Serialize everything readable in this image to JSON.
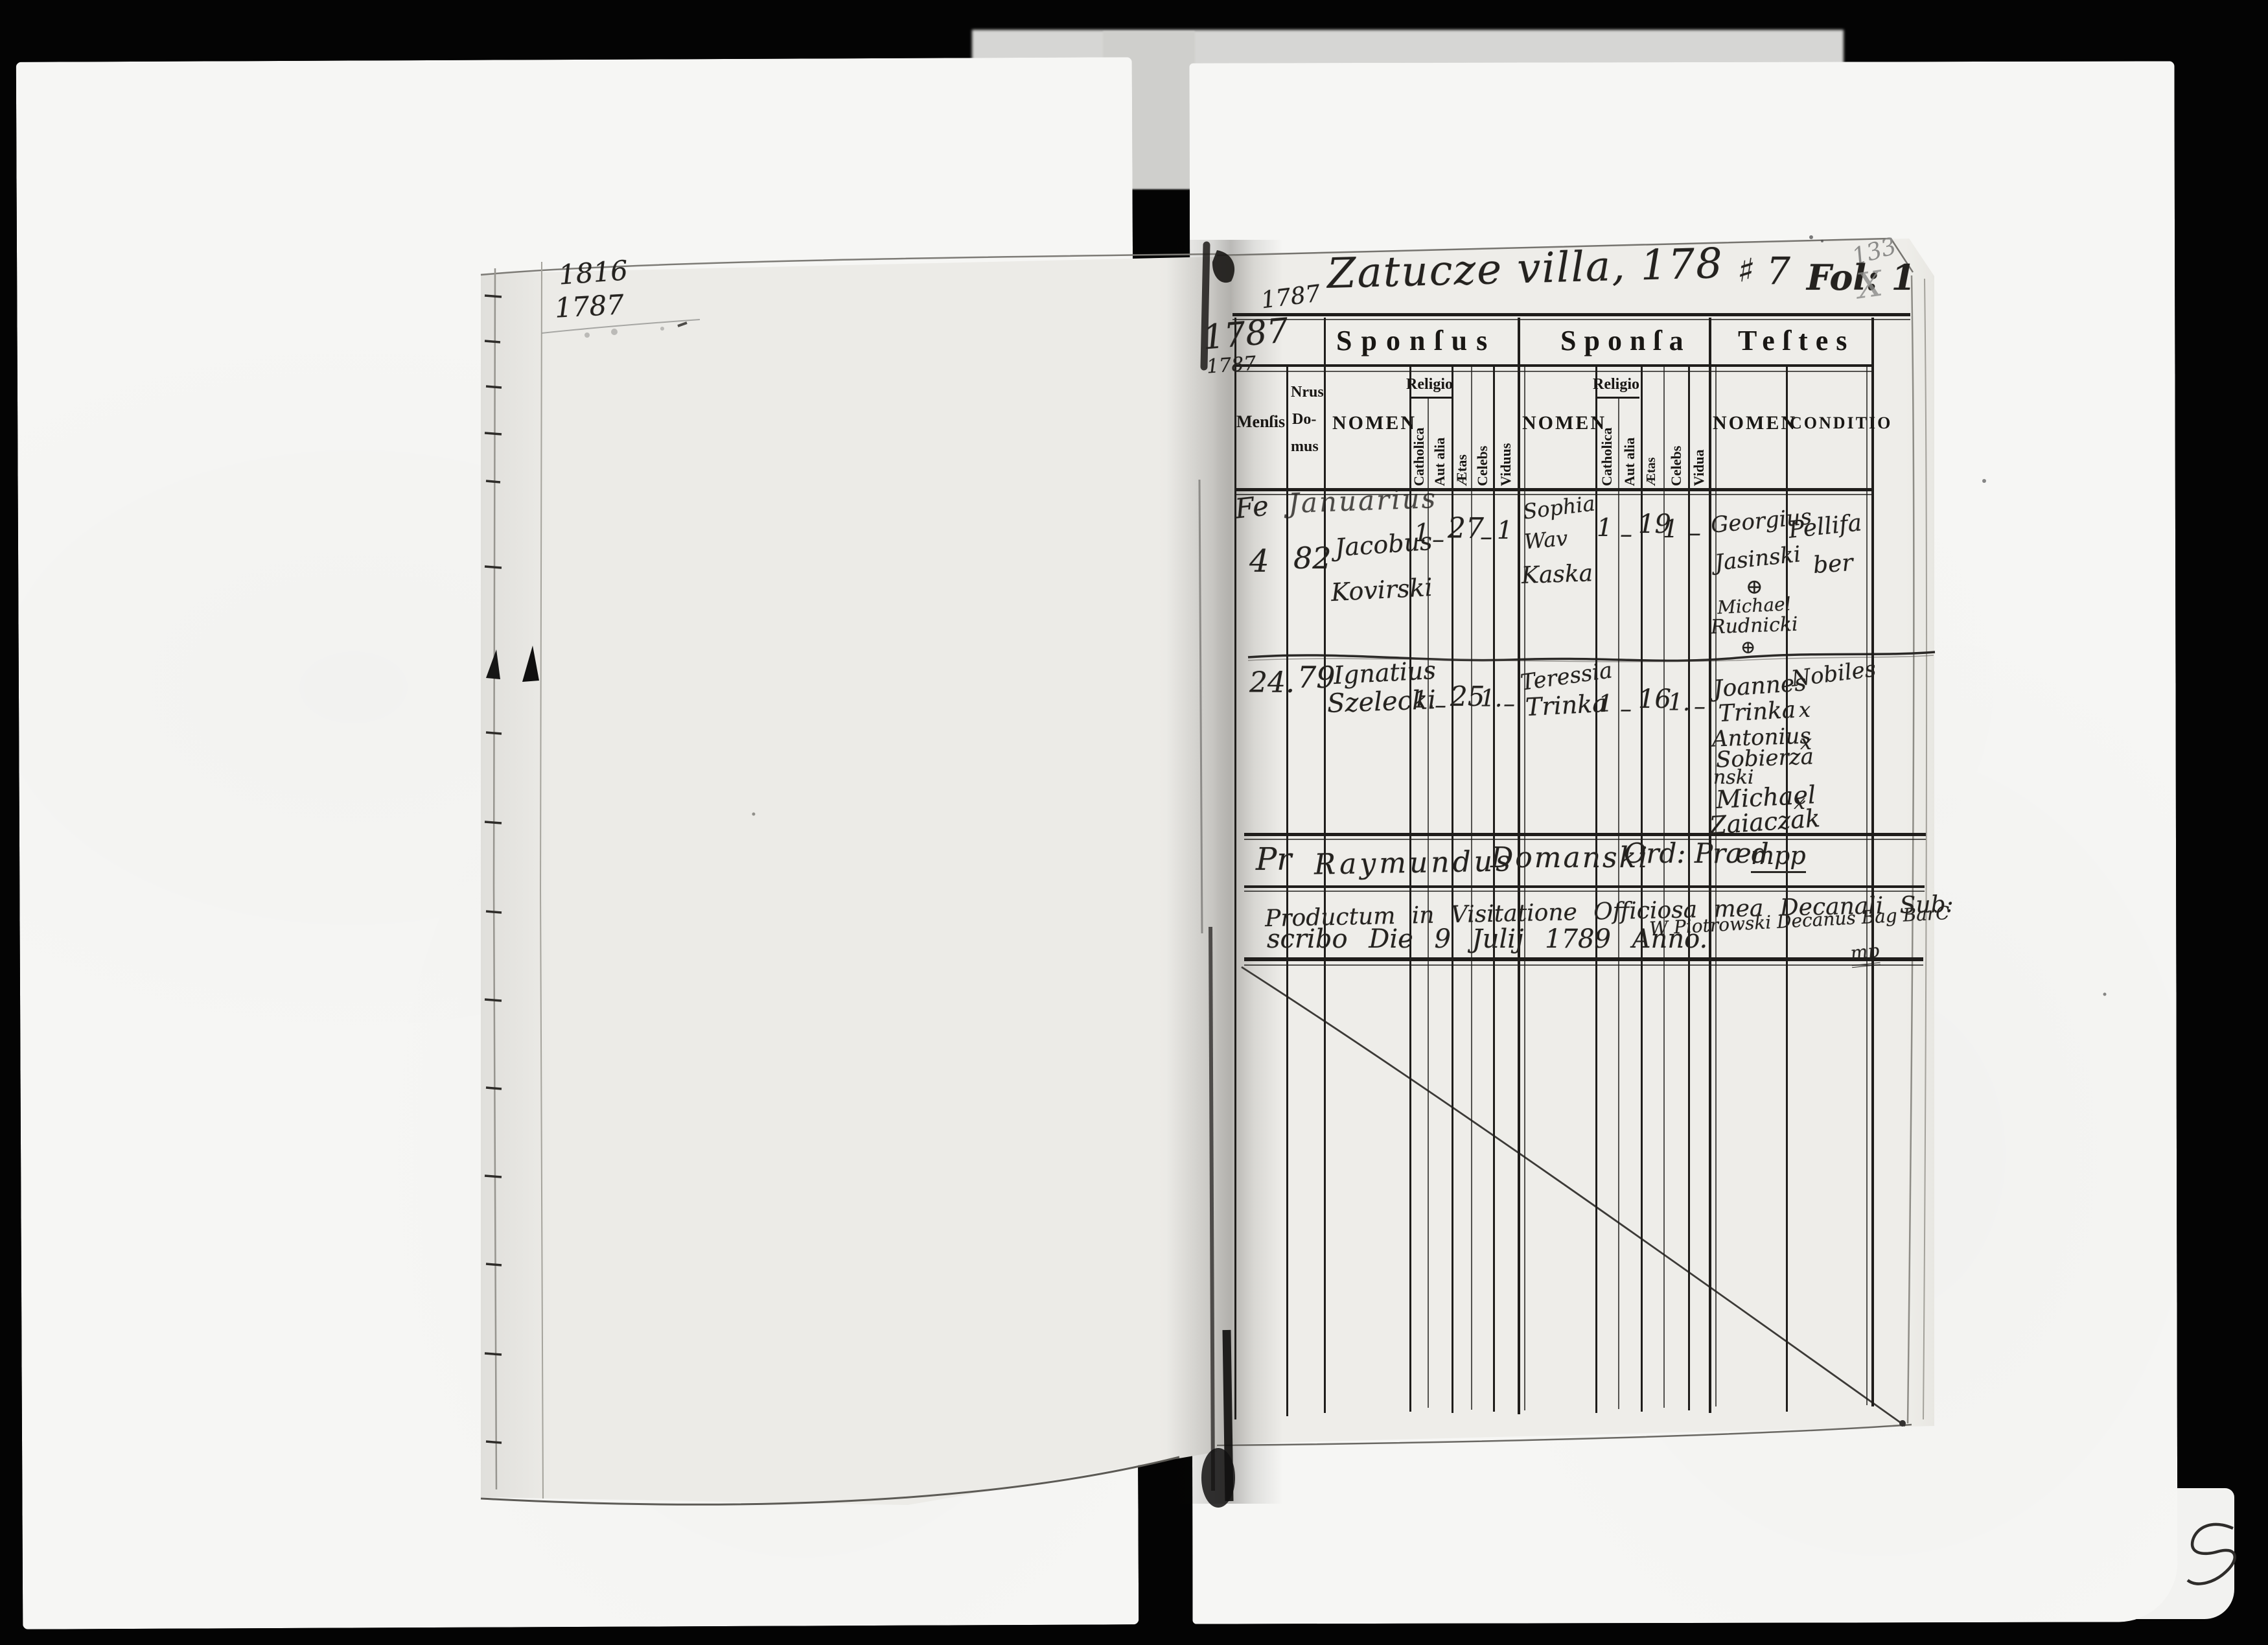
{
  "left_page": {
    "note_year_top": "1816",
    "note_year_bottom": "1787"
  },
  "right_page": {
    "pencil_folio": "133",
    "pencil_x": "X",
    "title": "Zatucze villa, 178",
    "title_mark": "♯",
    "title_suffix": "7",
    "folio": "Fol: 1",
    "margin_year": "1787",
    "cell_year_big": "1787",
    "cell_year_small": "1787"
  },
  "table": {
    "group_headers": {
      "sponsus": "Sponſus",
      "sponsa": "Sponſa",
      "testes": "Teſtes"
    },
    "columns": {
      "mensis": "Menſis",
      "nrus_line1": "Nrus",
      "nrus_line2": "Do-",
      "nrus_line3": "mus",
      "nomen": "NOMEN",
      "religio": "Religio",
      "catholica": "Catholica",
      "aut_alia": "Aut alia",
      "aetas": "Ætas",
      "celebs": "Celebs",
      "viduus": "Viduus",
      "vidua": "Vidua",
      "conditio": "CONDITIO"
    },
    "entries": [
      {
        "mensis_prefix": "Fe",
        "month": "Januarius",
        "day": "4",
        "domus": "82",
        "sponsus_line1": "Jacobus",
        "sponsus_line2": "Kovirski",
        "sponsus_catholica": "1",
        "sponsus_aut_alia": "–",
        "sponsus_aetas": "27",
        "sponsus_celebs": "–",
        "sponsus_viduus": "1",
        "sponsa_line1": "Sophia",
        "sponsa_line2": "Wav",
        "sponsa_line3": "Kaska",
        "sponsa_catholica": "1",
        "sponsa_aut_alia": "–",
        "sponsa_aetas": "19",
        "sponsa_celebs": "1",
        "sponsa_vidua": "–",
        "testis1_line1": "Georgius",
        "testis1_line2": "Jasinski",
        "testis1_mark": "⊕",
        "testis2_line1": "Michael",
        "testis2_line2": "Rudnicki",
        "testis2_mark": "⊕",
        "conditio_line1": "Pellifa",
        "conditio_line2": "ber"
      },
      {
        "day": "24.",
        "domus": "79",
        "sponsus_line1": "Ignatius",
        "sponsus_line2": "Szelecki",
        "sponsus_catholica": "1.",
        "sponsus_aut_alia": "–",
        "sponsus_aetas": "25",
        "sponsus_celebs": "1.",
        "sponsus_viduus": "–",
        "sponsa_line1": "Teressia",
        "sponsa_line2": "Trinka",
        "sponsa_catholica": "1",
        "sponsa_aut_alia": "–",
        "sponsa_aetas": "16",
        "sponsa_celebs": "1.",
        "sponsa_vidua": "–",
        "testis1_line1": "Joannes",
        "testis1_line2": "Trinka",
        "testis2_line1": "Antonius",
        "testis2_line2": "Sobierza",
        "testis2_line3": "nski",
        "testis3_line1": "Michael",
        "testis3_line2": "Zaiaczak",
        "conditio_line1": "Nobiles",
        "mark1": "x",
        "mark2": "x",
        "mark3": "x"
      }
    ],
    "signature": {
      "part1": "Pr",
      "part2": "Raymundus",
      "part3": "Domanski",
      "part4": "Ord: Præd",
      "part5": "mpp"
    },
    "visitation": {
      "line1": "Productum in Visitatione Officiosa mea Decanali Sub:",
      "line2": "scribo Die 9 Julij 1789 Anno.",
      "attestation": "W Piotrowski Decanus Bag BarC",
      "mp": "mp"
    }
  }
}
